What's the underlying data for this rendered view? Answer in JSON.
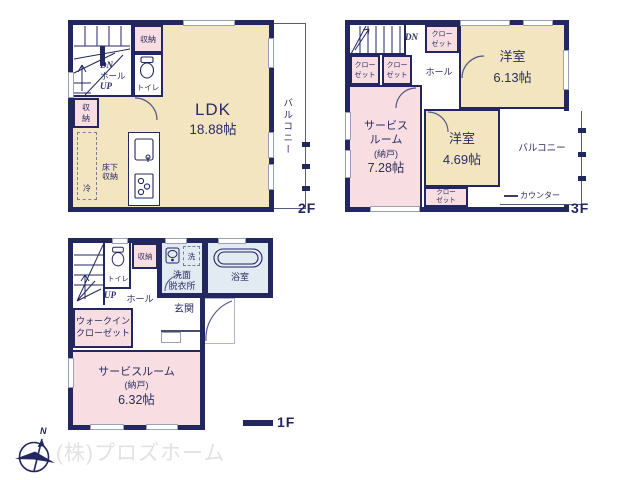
{
  "colors": {
    "wall": "#232760",
    "room_cream": "#f3e5c0",
    "room_pink": "#f8dee2",
    "room_bath": "#e2eaf2",
    "thin_line": "#565a85",
    "text": "#2a2d60",
    "watermark": "#e2e2e2"
  },
  "f2": {
    "floor_label": "2F",
    "ldk_name": "LDK",
    "ldk_size": "18.88帖",
    "balcony": "バルコニー",
    "dn": "DN",
    "hall": "ホール",
    "up": "UP",
    "closet_top": "収納",
    "closet_left": "収納",
    "toilet": "トイレ",
    "underfloor_storage": "床下収納",
    "fridge": "冷"
  },
  "f3": {
    "floor_label": "3F",
    "dn": "DN",
    "hall": "ホール",
    "closet_top": "クローゼット",
    "closet_left1": "クローゼット",
    "closet_left2": "クローゼット",
    "closet_bottom": "クローゼット",
    "room1_name": "洋室",
    "room1_size": "6.13帖",
    "room2_name": "洋室",
    "room2_size": "4.69帖",
    "service_name": "サービスルーム",
    "service_annex": "(納戸)",
    "service_size": "7.28帖",
    "balcony": "バルコニー",
    "counter": "カウンター"
  },
  "f1": {
    "floor_label": "1F",
    "up": "UP",
    "hall": "ホール",
    "toilet": "トイレ",
    "closet": "収納",
    "washer": "洗",
    "washroom_line1": "洗面",
    "washroom_line2": "脱衣所",
    "bath": "浴室",
    "entrance": "玄関",
    "wic": "ウォークインクローゼット",
    "service_name": "サービスルーム",
    "service_annex": "(納戸)",
    "service_size": "6.32帖"
  },
  "compass_north": "N",
  "watermark": "(株)プロズホーム"
}
